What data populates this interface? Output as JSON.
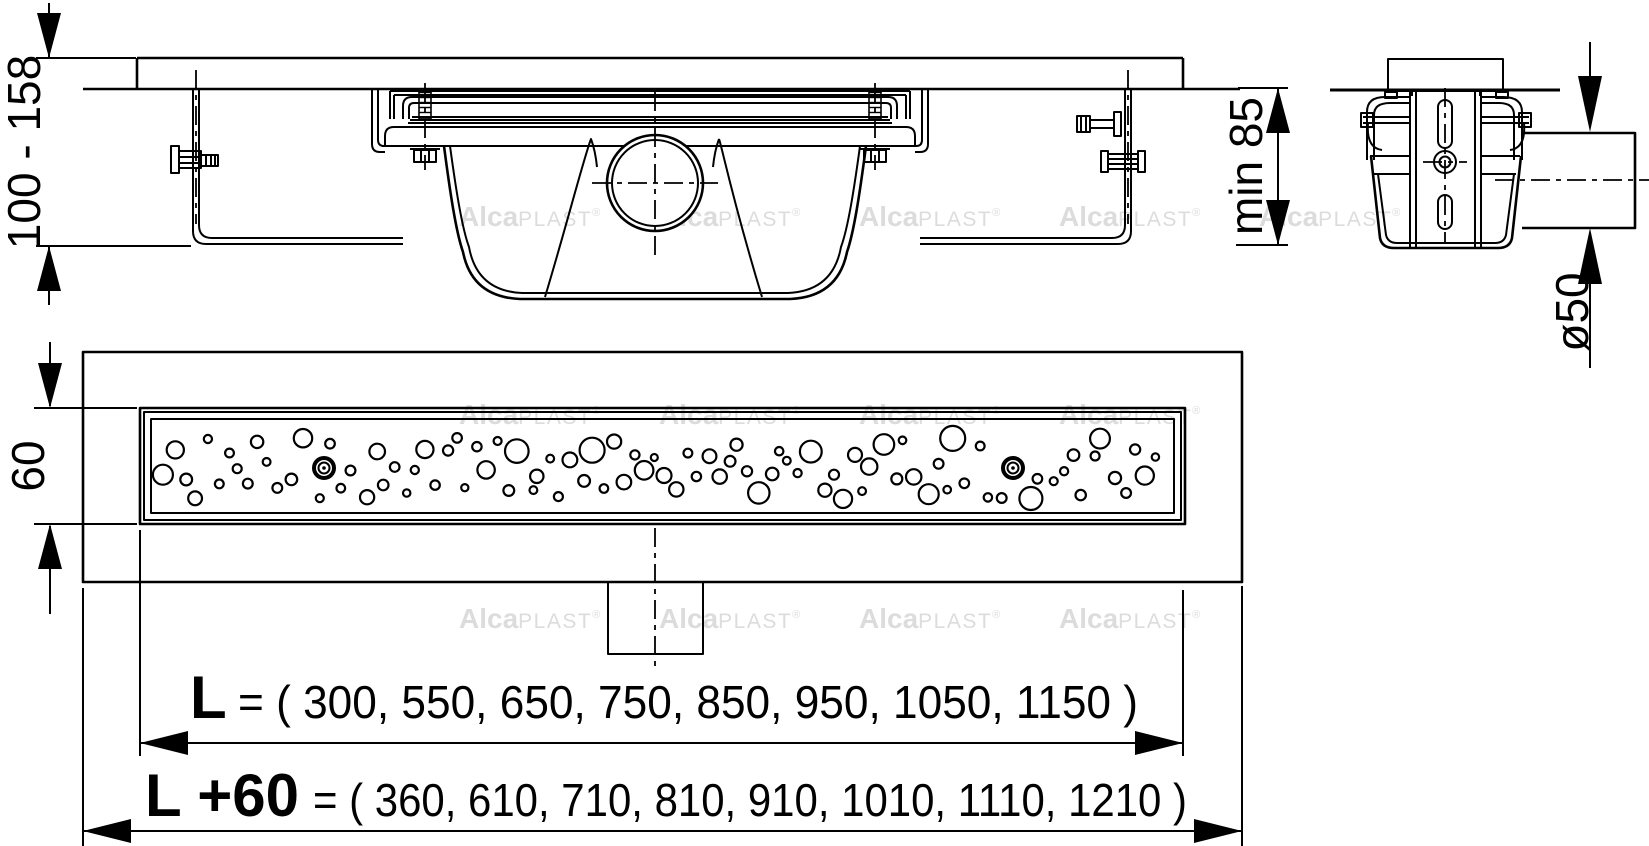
{
  "drawing": {
    "dimensions": {
      "install_height_range": "100 - 158",
      "min_embed_depth": "min 85",
      "outlet_diameter": "ø50",
      "grate_width": "60"
    },
    "length_row": {
      "label": "L",
      "equals_values": "= ( 300, 550, 650, 750, 850, 950, 1050, 1150 )"
    },
    "total_length_row": {
      "label": "L +60",
      "equals_values": "= ( 360, 610, 710, 810, 910, 1010, 1110, 1210 )"
    },
    "channel_lengths_mm": [
      300,
      550,
      650,
      750,
      850,
      950,
      1050,
      1150
    ],
    "total_lengths_mm": [
      360,
      610,
      710,
      810,
      910,
      1010,
      1110,
      1210
    ],
    "watermark": {
      "bold": "Alca",
      "light": "PLAST",
      "mark": "®"
    },
    "colors": {
      "line": "#000000",
      "watermark": "#dcdcdc",
      "background": "#ffffff"
    }
  }
}
